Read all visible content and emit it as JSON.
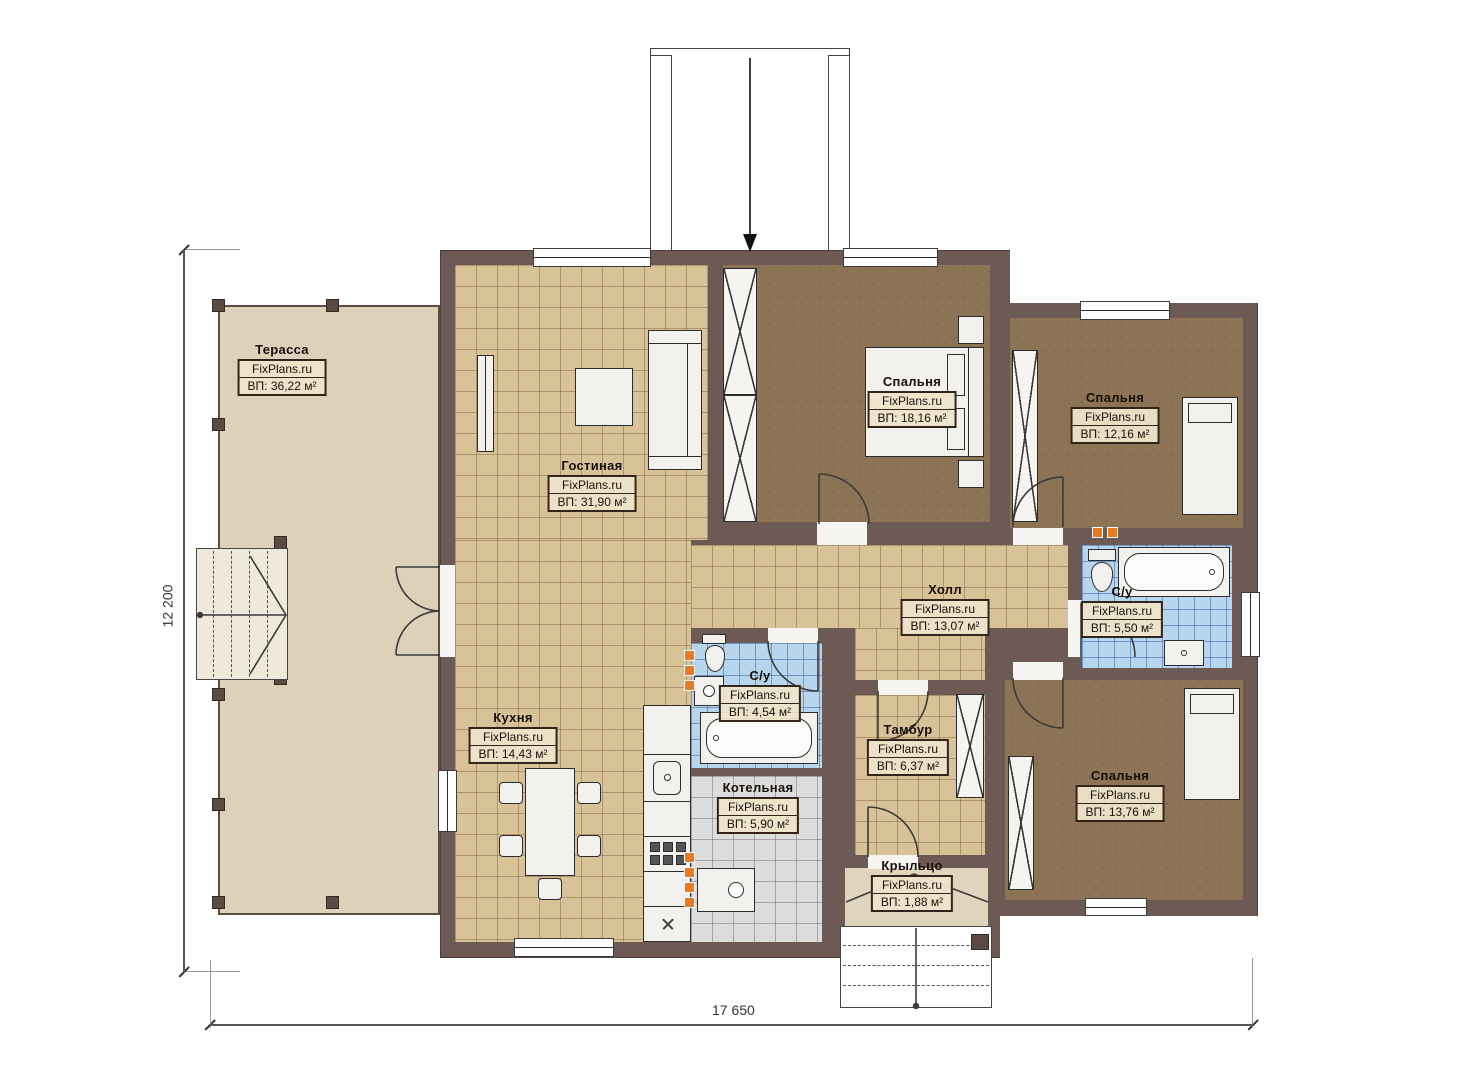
{
  "brand": "FixPlans.ru",
  "dimensions": {
    "width_label": "17 650",
    "height_label": "12 200"
  },
  "rooms": [
    {
      "id": "terrace",
      "name": "Терасса",
      "area": "ВП: 36,22 м²"
    },
    {
      "id": "living",
      "name": "Гостиная",
      "area": "ВП: 31,90 м²"
    },
    {
      "id": "bedroom-1",
      "name": "Спальня",
      "area": "ВП: 18,16 м²"
    },
    {
      "id": "bedroom-2",
      "name": "Спальня",
      "area": "ВП: 12,16 м²"
    },
    {
      "id": "hall",
      "name": "Холл",
      "area": "ВП: 13,07 м²"
    },
    {
      "id": "bathroom-1",
      "name": "С/у",
      "area": "ВП: 5,50 м²"
    },
    {
      "id": "kitchen",
      "name": "Кухня",
      "area": "ВП: 14,43 м²"
    },
    {
      "id": "bathroom-2",
      "name": "С/у",
      "area": "ВП: 4,54 м²"
    },
    {
      "id": "vestibule",
      "name": "Тамбур",
      "area": "ВП: 6,37 м²"
    },
    {
      "id": "boiler",
      "name": "Котельная",
      "area": "ВП: 5,90 м²"
    },
    {
      "id": "bedroom-3",
      "name": "Спальня",
      "area": "ВП: 13,76 м²"
    },
    {
      "id": "porch",
      "name": "Крыльцо",
      "area": "ВП: 1,88 м²"
    }
  ],
  "icons": {
    "entrance_arrow": "▼"
  },
  "colors": {
    "wall": "#6e5a55",
    "floor": "#d8c298",
    "bedroom_floor": "#8c7355",
    "bath_tile": "#b7d6ee",
    "boiler_tile": "#dcdcdc",
    "terrace": "#ddd1ba",
    "porch": "#e0d5bc",
    "radiator": "#e87a22"
  }
}
